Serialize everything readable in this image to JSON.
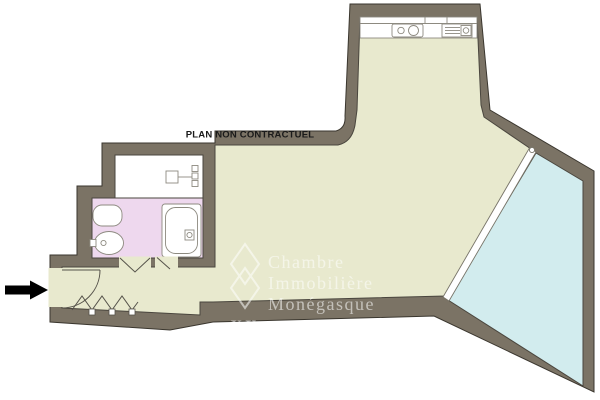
{
  "plan": {
    "disclaimer": "PLAN NON CONTRACTUEL",
    "watermark": {
      "line1": "Chambre",
      "line2": "Immobilière",
      "line3": "Monégasque",
      "mark": "XX"
    }
  },
  "colors": {
    "wall": "#7b7365",
    "wall_outline": "#3a362e",
    "floor_main": "#e8e9ce",
    "floor_bathroom": "#eed8ee",
    "floor_dressing": "#ffffff",
    "window_glass": "#d2ecee",
    "window_frame": "#ffffff",
    "fixture_stroke": "#8d8a80",
    "door_stroke": "#55524a",
    "arrow": "#000000",
    "text": "#1a1a1a",
    "background": "#ffffff"
  },
  "fixtures": [
    "kitchen-sink",
    "cooktop-appliance",
    "radiator",
    "toilet",
    "bidet",
    "bathtub",
    "entrance-door",
    "bifold-door",
    "folding-closet-doors",
    "window-bay",
    "entrance-arrow"
  ]
}
